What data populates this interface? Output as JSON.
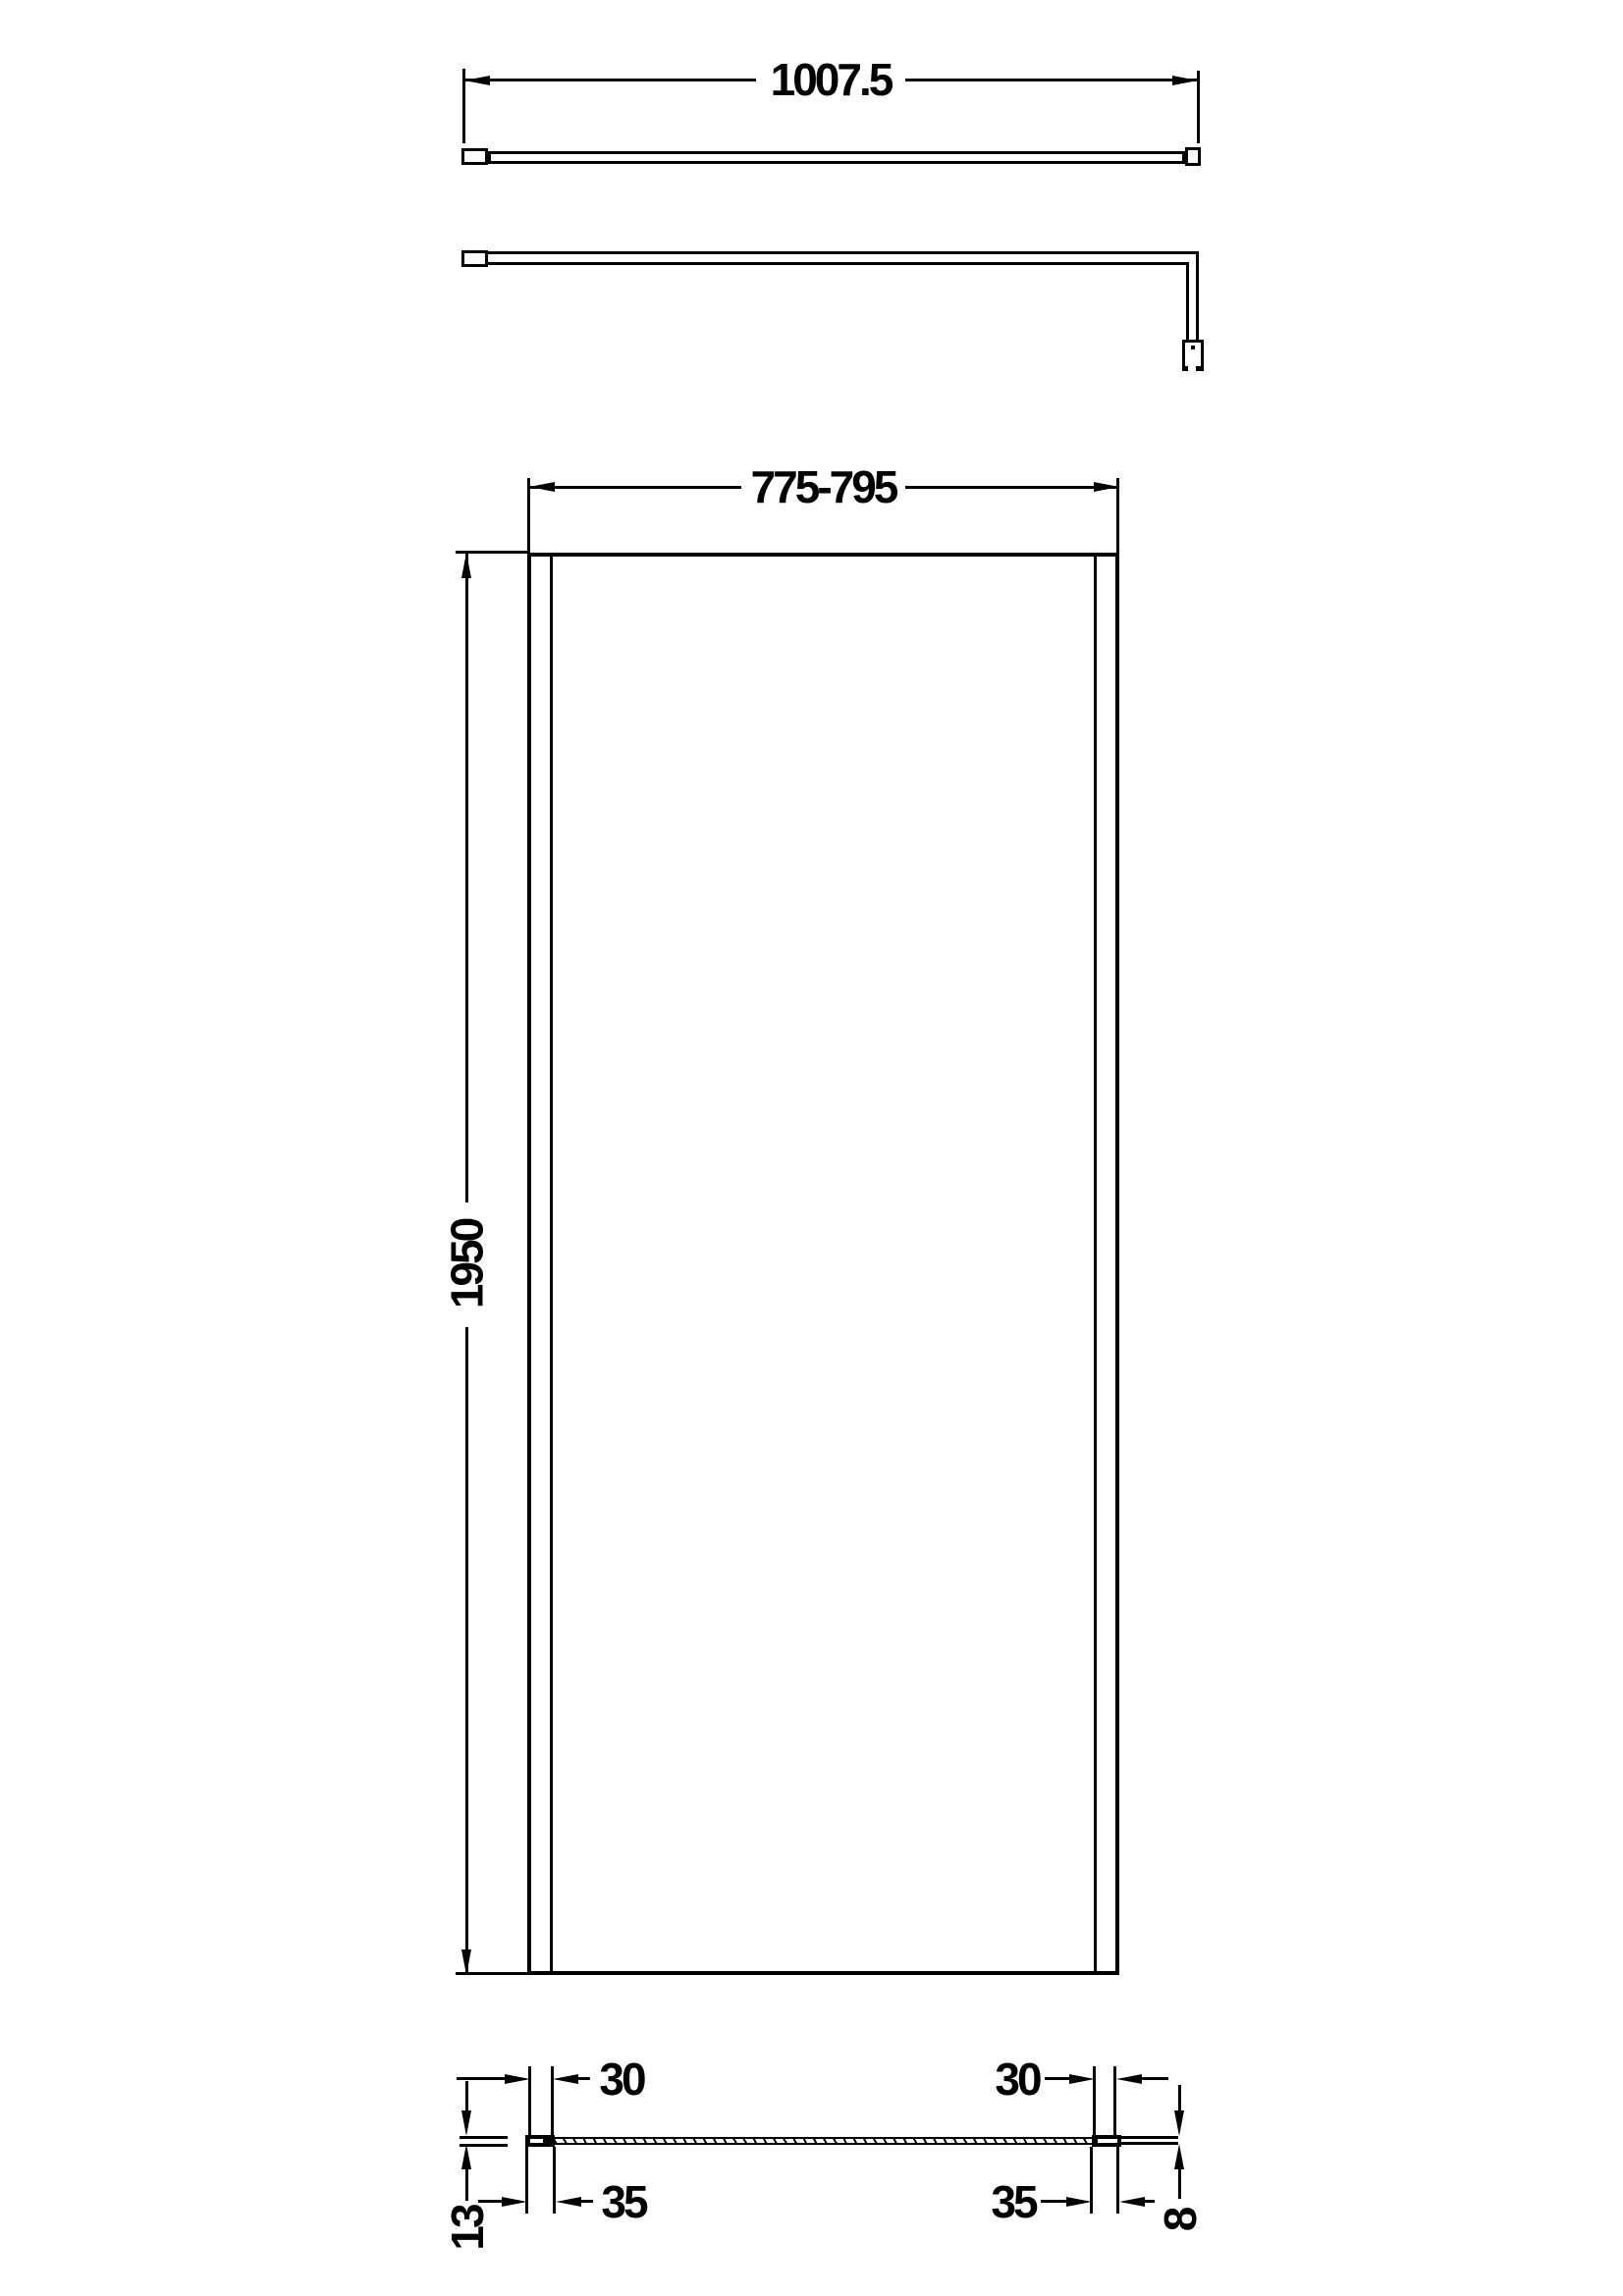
{
  "colors": {
    "line": "#000000",
    "background": "#ffffff"
  },
  "dimensions": {
    "arm_length": "1007.5",
    "screen_width_range": "775-795",
    "screen_height": "1950",
    "profile_left_adjust": "30",
    "profile_right_adjust": "30",
    "profile_left_width": "35",
    "profile_right_width": "35",
    "profile_depth": "13",
    "glass_thickness": "8"
  }
}
